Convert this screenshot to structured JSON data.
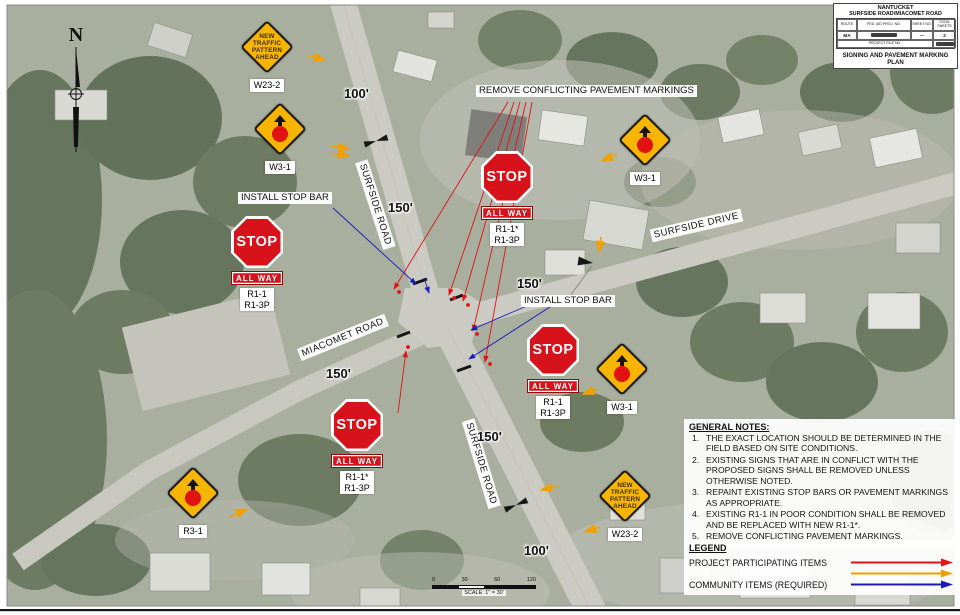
{
  "title_block": {
    "municipality": "NANTUCKET",
    "road_line": "SURFSIDE ROAD/MIACOMET ROAD",
    "plan_title": "SIGNING AND PAVEMENT MARKING PLAN",
    "table": {
      "route_h": "ROUTE",
      "proj_h": "FED. AID PROJ. NO.",
      "sheet_h": "SHEET NO.",
      "total_h": "TOTAL SHEETS",
      "route_v": "MA",
      "sheet_v": "—",
      "total_v": "2",
      "file_h": "PROJECT FILE NO."
    }
  },
  "compass": {
    "n": "N"
  },
  "roads": {
    "surfside_road": "SURFSIDE ROAD",
    "surfside_drive": "SURFSIDE DRIVE",
    "miacomet_road": "MIACOMET ROAD"
  },
  "callouts": {
    "remove_markings": "REMOVE CONFLICTING PAVEMENT MARKINGS",
    "install_stop_bar": "INSTALL STOP BAR"
  },
  "distances": {
    "top_100": "100'",
    "top_150": "150'",
    "mid_150": "150'",
    "left_150": "150'",
    "low_150": "150'",
    "bottom_100": "100'"
  },
  "signs": {
    "stop_word": "STOP",
    "all_way": "ALL WAY",
    "r1": "R1-1",
    "r1_star": "R1-1*",
    "r1_3p": "R1-3P",
    "w3_label": "W3-1",
    "r3_label": "R3-1",
    "w23_label": "W23-2",
    "w23_lines": [
      "NEW",
      "TRAFFIC",
      "PATTERN",
      "AHEAD"
    ]
  },
  "notes": {
    "title": "GENERAL NOTES:",
    "items": [
      {
        "num": "1.",
        "text": "THE EXACT LOCATION SHOULD BE DETERMINED IN THE FIELD BASED ON SITE CONDITIONS."
      },
      {
        "num": "2.",
        "text": "EXISTING SIGNS THAT ARE IN CONFLICT WITH THE PROPOSED SIGNS SHALL BE REMOVED UNLESS OTHERWISE NOTED."
      },
      {
        "num": "3.",
        "text": "REPAINT EXISTING STOP BARS OR PAVEMENT MARKINGS AS APPROPRIATE."
      },
      {
        "num": "4.",
        "text": "EXISTING R1-1 IN POOR CONDITION SHALL BE REMOVED AND BE REPLACED WITH NEW R1-1*."
      },
      {
        "num": "5.",
        "text": "REMOVE CONFLICTING PAVEMENT MARKINGS."
      }
    ]
  },
  "legend": {
    "title": "LEGEND",
    "project_label": "PROJECT PARTICIPATING ITEMS",
    "community_label": "COMMUNITY ITEMS (REQUIRED)",
    "colors": {
      "project": "#e01212",
      "secondary": "#f0a000",
      "community": "#1a1ab8"
    }
  },
  "scale": {
    "ticks": [
      "0",
      "30",
      "60",
      "120"
    ],
    "label": "SCALE: 1\" = 30'"
  }
}
